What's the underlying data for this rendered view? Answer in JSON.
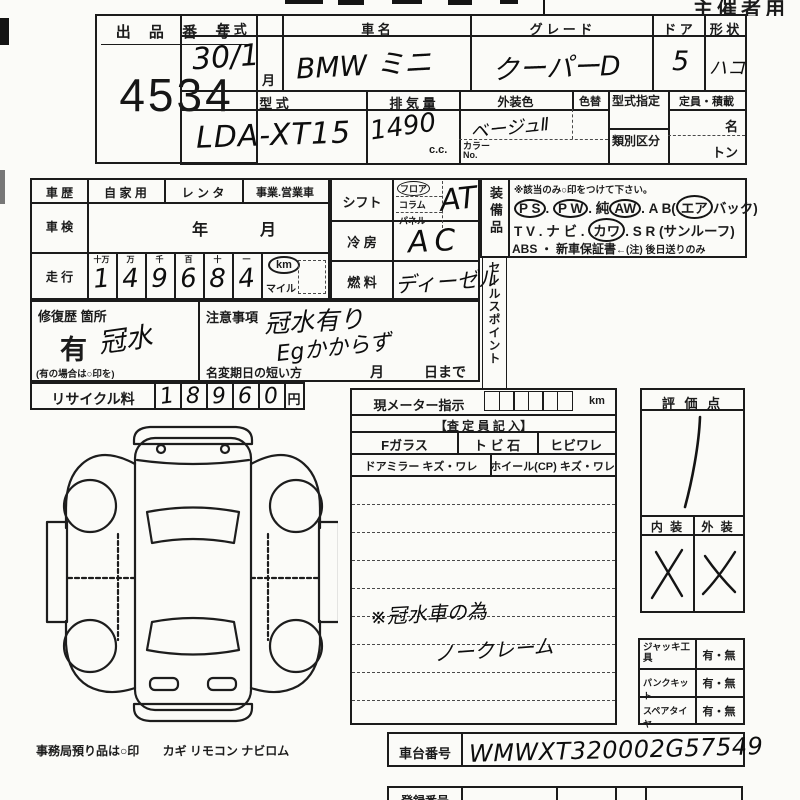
{
  "page": {
    "organizer_label": "主催者用",
    "office_note_1": "事務局預り品は○印",
    "office_note_2": "カギ  リモコン  ナビロム"
  },
  "lot": {
    "label": "出 品 番 号",
    "value": "4534"
  },
  "vehicle": {
    "year_label": "年    式",
    "year_value": "30/1",
    "year_month_unit": "月",
    "name_label": "車        名",
    "name_value": "BMW ミニ",
    "grade_label": "グ レ ー ド",
    "grade_value": "クーパーD",
    "doors_label": "ド ア",
    "doors_value": "5",
    "shape_label": "形 状",
    "shape_value": "ハコ",
    "model_label": "型    式",
    "model_value": "LDA-XT15",
    "disp_label": "排 気 量",
    "disp_value": "1490",
    "disp_unit": "c.c.",
    "color_label": "外装色",
    "color_value": "ベージュⅡ",
    "color_change_label": "色替",
    "color_no_label": "カラーNo.",
    "type_desig_label": "型式指定",
    "class_label": "類別区分",
    "capacity_label": "定員・積載",
    "capacity_persons_unit": "名",
    "capacity_tons_unit": "トン"
  },
  "history": {
    "label": "車  歴",
    "options": [
      "自 家 用",
      "レ ン タ",
      "事業.営業車"
    ]
  },
  "shaken": {
    "label": "車  検",
    "year_unit": "年",
    "month_unit": "月"
  },
  "mileage": {
    "label": "走  行",
    "headers": [
      "十万",
      "万",
      "千",
      "百",
      "十",
      "一"
    ],
    "digits": [
      "1",
      "4",
      "9",
      "6",
      "8",
      "4"
    ],
    "unit_km": "km",
    "unit_mile": "マイル"
  },
  "shift": {
    "label": "シフト",
    "options": [
      "フロア",
      "コラム",
      "パネル"
    ],
    "value": "AT"
  },
  "cooling": {
    "label": "冷 房",
    "value": "AC"
  },
  "fuel": {
    "label": "燃 料",
    "value": "ディーゼル"
  },
  "equipment": {
    "label": "装備品",
    "note": "※該当のみ○印をつけて下さい。",
    "l1": [
      {
        "t": "P S",
        "c": true
      },
      {
        "t": ".  ",
        "c": false
      },
      {
        "t": "P W",
        "c": true
      },
      {
        "t": ".  純",
        "c": false
      },
      {
        "t": "AW",
        "c": true
      },
      {
        "t": ".  A B(",
        "c": false
      },
      {
        "t": "エア",
        "c": true
      },
      {
        "t": "バック)",
        "c": false
      }
    ],
    "l2": [
      {
        "t": "T V .  ナ ビ .  ",
        "c": false
      },
      {
        "t": "カワ",
        "c": true
      },
      {
        "t": ".  S R (サンルーフ)",
        "c": false
      }
    ],
    "l3a": "ABS ・ 新車保証書",
    "l3b": "←(注) 後日送りのみ"
  },
  "sales_point": {
    "label": "セールスポイント"
  },
  "repair": {
    "label": "修復歴 箇所",
    "printed_value": "有",
    "hand_value": "冠水",
    "note": "(有の場合は○印を)"
  },
  "caution": {
    "label": "注意事項",
    "hand_line1": "冠水有り",
    "hand_line2": "Egかからず",
    "transfer_label": "名変期日の短い方",
    "month_unit": "月",
    "day_unit": "日まで"
  },
  "recycle": {
    "label": "リサイクル料",
    "digits": [
      "1",
      "8",
      "9",
      "6",
      "0"
    ],
    "unit": "円"
  },
  "meter": {
    "label": "現メーター指示",
    "unit": "km"
  },
  "assessor": {
    "header": "【査 定 員 記 入】",
    "row1": [
      "Fガラス",
      "ト ビ 石",
      "ヒビワレ"
    ],
    "row2": [
      "ドアミラー  キズ・ワレ",
      "ホイール(CP)  キズ・ワレ"
    ],
    "hand_note1": "※冠水車の為",
    "hand_note2": "ノークレーム"
  },
  "evaluation": {
    "label": "評 価 点",
    "score": "1",
    "interior_label": "内 装",
    "exterior_label": "外 装",
    "interior_mark": "X",
    "exterior_mark": "X"
  },
  "accessories": {
    "rows": [
      {
        "label": "ジャッキ工具",
        "value": "有・無"
      },
      {
        "label": "パンクキット",
        "value": "有・無"
      },
      {
        "label": "スペアタイヤ",
        "value": "有・無"
      }
    ]
  },
  "chassis": {
    "label": "車台番号",
    "value": "WMWXT320002G57549"
  },
  "bottom_row": {
    "label": "登録番号"
  }
}
